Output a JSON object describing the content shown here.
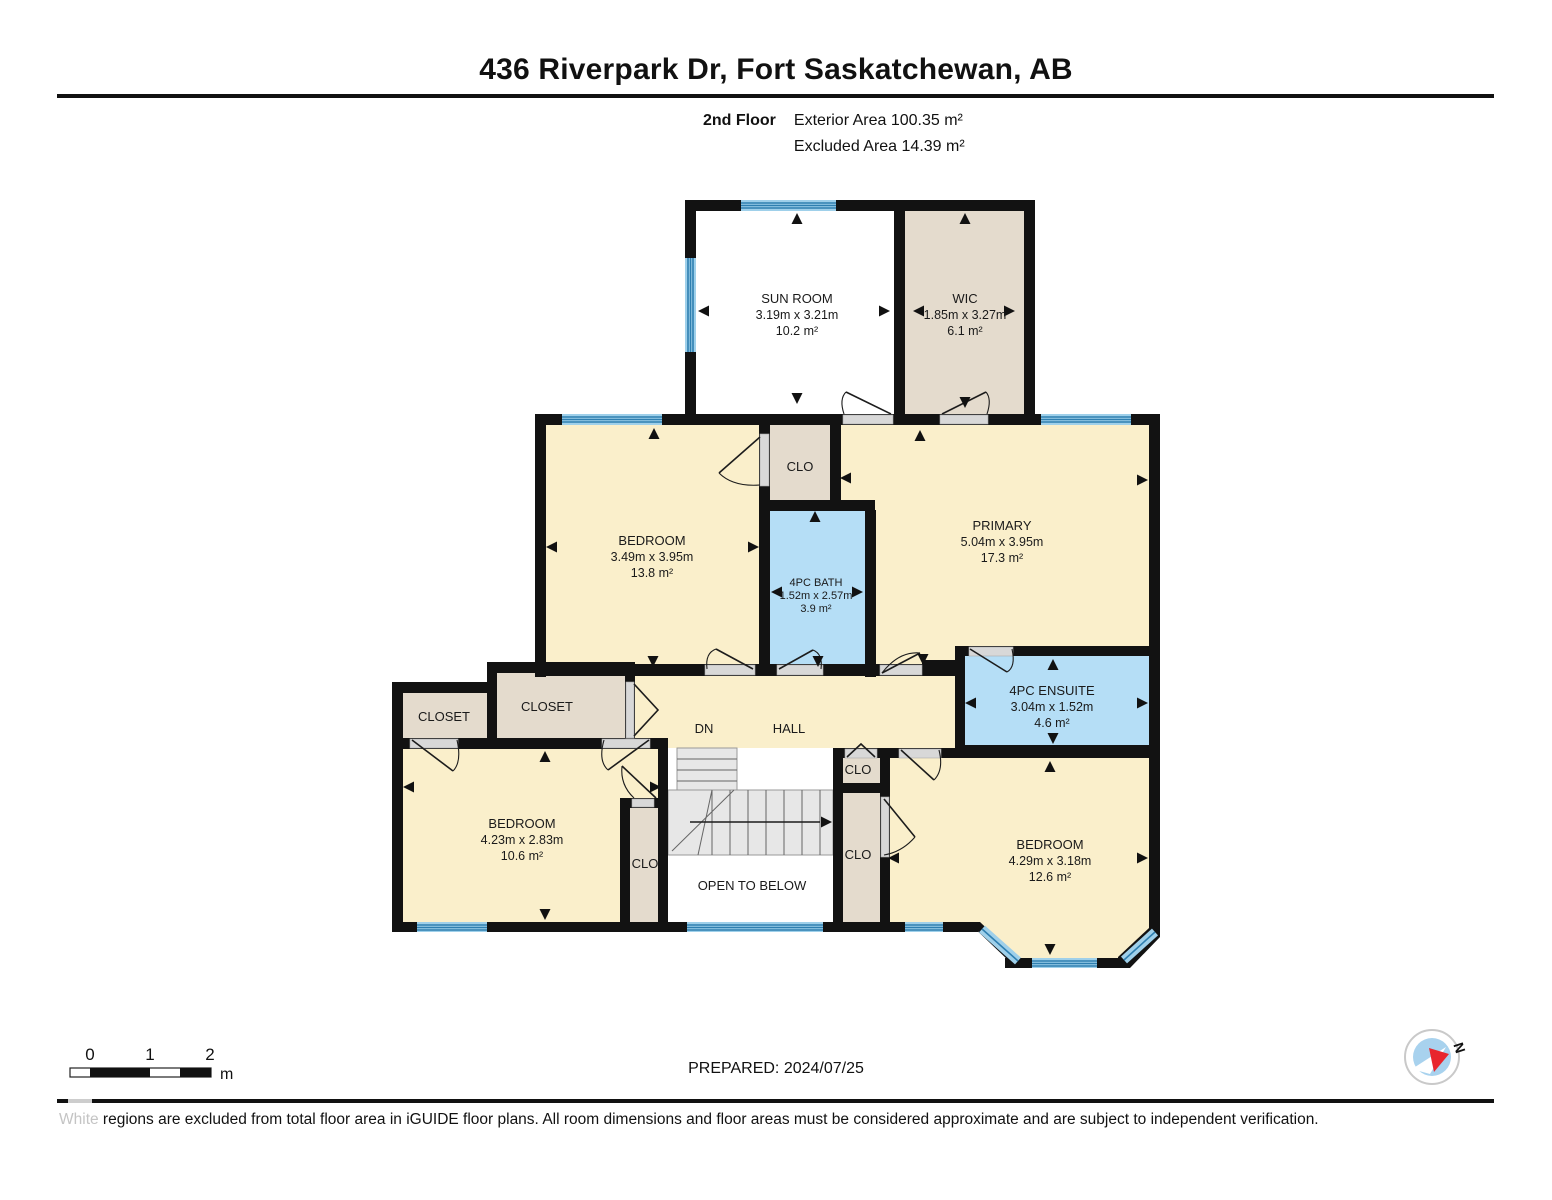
{
  "header": {
    "title": "436 Riverpark Dr, Fort Saskatchewan, AB",
    "floor_label": "2nd Floor",
    "exterior_area": "Exterior Area 100.35 m²",
    "excluded_area": "Excluded Area 14.39 m²"
  },
  "rooms": {
    "sun_room": {
      "name": "SUN ROOM",
      "dims": "3.19m x 3.21m",
      "area": "10.2 m²"
    },
    "wic": {
      "name": "WIC",
      "dims": "1.85m x 3.27m",
      "area": "6.1 m²"
    },
    "bedroom_mid": {
      "name": "BEDROOM",
      "dims": "3.49m x 3.95m",
      "area": "13.8 m²"
    },
    "clo_center": {
      "name": "CLO"
    },
    "bath": {
      "name": "4PC BATH",
      "dims": "1.52m x 2.57m",
      "area": "3.9 m²"
    },
    "primary": {
      "name": "PRIMARY",
      "dims": "5.04m x 3.95m",
      "area": "17.3 m²"
    },
    "ensuite": {
      "name": "4PC ENSUITE",
      "dims": "3.04m x 1.52m",
      "area": "4.6 m²"
    },
    "closet_left": {
      "name": "CLOSET"
    },
    "closet_mid": {
      "name": "CLOSET"
    },
    "hall": {
      "name": "HALL"
    },
    "stairs": {
      "dn_label": "DN"
    },
    "bedroom_bl": {
      "name": "BEDROOM",
      "dims": "4.23m x 2.83m",
      "area": "10.6 m²"
    },
    "clo_stairs": {
      "name": "CLO"
    },
    "clo_right_top": {
      "name": "CLO"
    },
    "clo_right": {
      "name": "CLO"
    },
    "bedroom_br": {
      "name": "BEDROOM",
      "dims": "4.29m x 3.18m",
      "area": "12.6 m²"
    },
    "open_to_below": {
      "name": "OPEN TO BELOW"
    }
  },
  "footer": {
    "scale": {
      "tick_0": "0",
      "tick_1": "1",
      "tick_2": "2",
      "unit": "m"
    },
    "prepared": "PREPARED: 2024/07/25",
    "compass_label": "N",
    "disclaimer_highlight": "White",
    "disclaimer_text": " regions are excluded from total floor area in iGUIDE floor plans. All room dimensions and floor areas must be considered approximate and are subject to independent verification."
  },
  "colors": {
    "room_fill": "#FAEFCB",
    "closet_fill": "#E4DBCD",
    "bath_fill": "#B5DEF6",
    "excluded_fill": "#FFFFFF",
    "wall": "#121212",
    "window_light": "#9FD0EA",
    "window_dark": "#2E7FB0",
    "door_opening": "#D8D8D8",
    "stair_fill": "#E7E7E7",
    "compass_blue": "#A8D2EE",
    "compass_red": "#E8262D"
  }
}
